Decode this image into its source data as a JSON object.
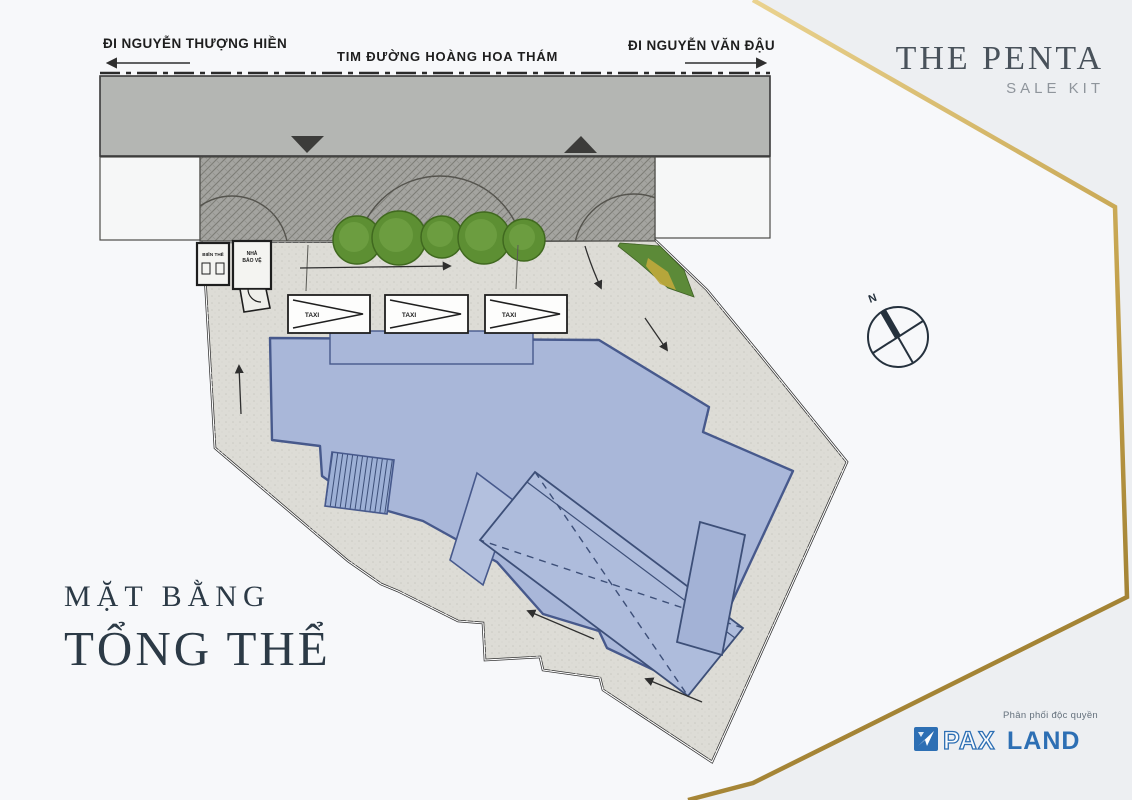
{
  "brand": {
    "title": "THE PENTA",
    "subtitle": "SALE KIT"
  },
  "plan_title": {
    "line1": "MẶT BẰNG",
    "line2": "TỔNG THỂ"
  },
  "road": {
    "center_label": "TIM ĐƯỜNG HOÀNG HOA THÁM",
    "left_direction": "ĐI NGUYỄN THƯỢNG HIỀN",
    "right_direction": "ĐI NGUYỄN VĂN ĐẬU"
  },
  "site": {
    "taxi_label": "TAXI",
    "transformer_label": "BIẾN THẾ",
    "guard_house_line1": "NHÀ",
    "guard_house_line2": "BẢO VỆ"
  },
  "compass": {
    "north_label": "N"
  },
  "footer": {
    "distribution_note": "Phân phối độc quyền",
    "brand_part1": "PAX",
    "brand_part2": "LAND"
  },
  "colors": {
    "gold": "#c3a14b",
    "blue-fill": "#a9b7d9",
    "blue-stroke": "#47598c",
    "road": "#b4b6b3",
    "ink": "#2c3a46",
    "brand-blue": "#2d6fb4"
  }
}
